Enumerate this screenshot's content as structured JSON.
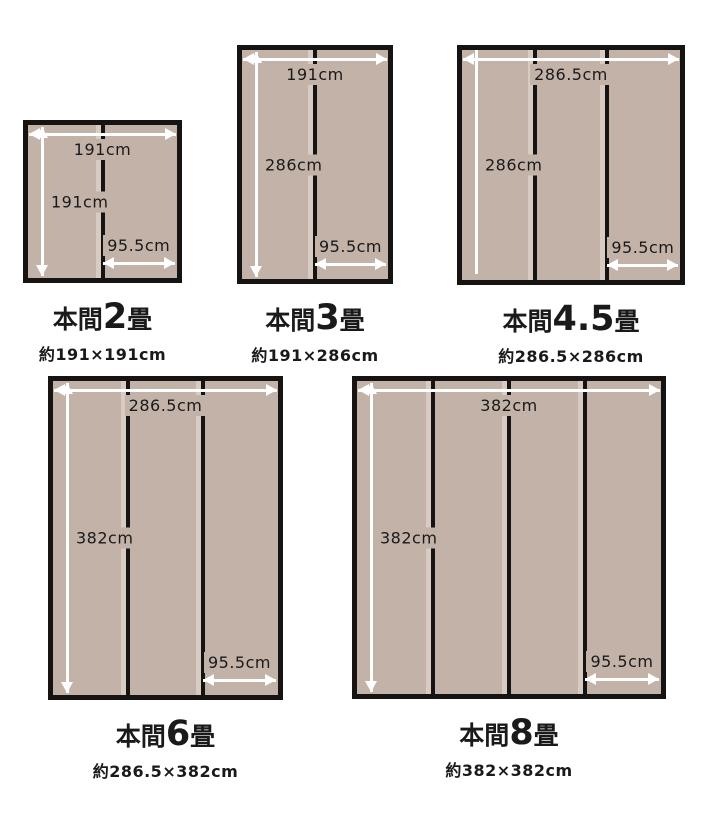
{
  "colors": {
    "page_bg": "#ffffff",
    "mat_fill": "#c3b2a8",
    "seam_highlight": "#d8ccc2",
    "outline": "#161413",
    "arrow": "#ffffff",
    "ink": "#1a1a1a"
  },
  "diagrams": [
    {
      "id": "honma-2jo",
      "title_prefix": "本間",
      "title_size": "2",
      "title_suffix": "畳",
      "subtitle": "約191×191cm",
      "width_label": "191cm",
      "height_label": "191cm",
      "seam_label": "95.5cm"
    },
    {
      "id": "honma-3jo",
      "title_prefix": "本間",
      "title_size": "3",
      "title_suffix": "畳",
      "subtitle": "約191×286cm",
      "width_label": "191cm",
      "height_label": "286cm",
      "seam_label": "95.5cm"
    },
    {
      "id": "honma-4-5jo",
      "title_prefix": "本間",
      "title_size": "4.5",
      "title_suffix": "畳",
      "subtitle": "約286.5×286cm",
      "width_label": "286.5cm",
      "height_label": "286cm",
      "seam_label": "95.5cm"
    },
    {
      "id": "honma-6jo",
      "title_prefix": "本間",
      "title_size": "6",
      "title_suffix": "畳",
      "subtitle": "約286.5×382cm",
      "width_label": "286.5cm",
      "height_label": "382cm",
      "seam_label": "95.5cm"
    },
    {
      "id": "honma-8jo",
      "title_prefix": "本間",
      "title_size": "8",
      "title_suffix": "畳",
      "subtitle": "約382×382cm",
      "width_label": "382cm",
      "height_label": "382cm",
      "seam_label": "95.5cm"
    }
  ]
}
